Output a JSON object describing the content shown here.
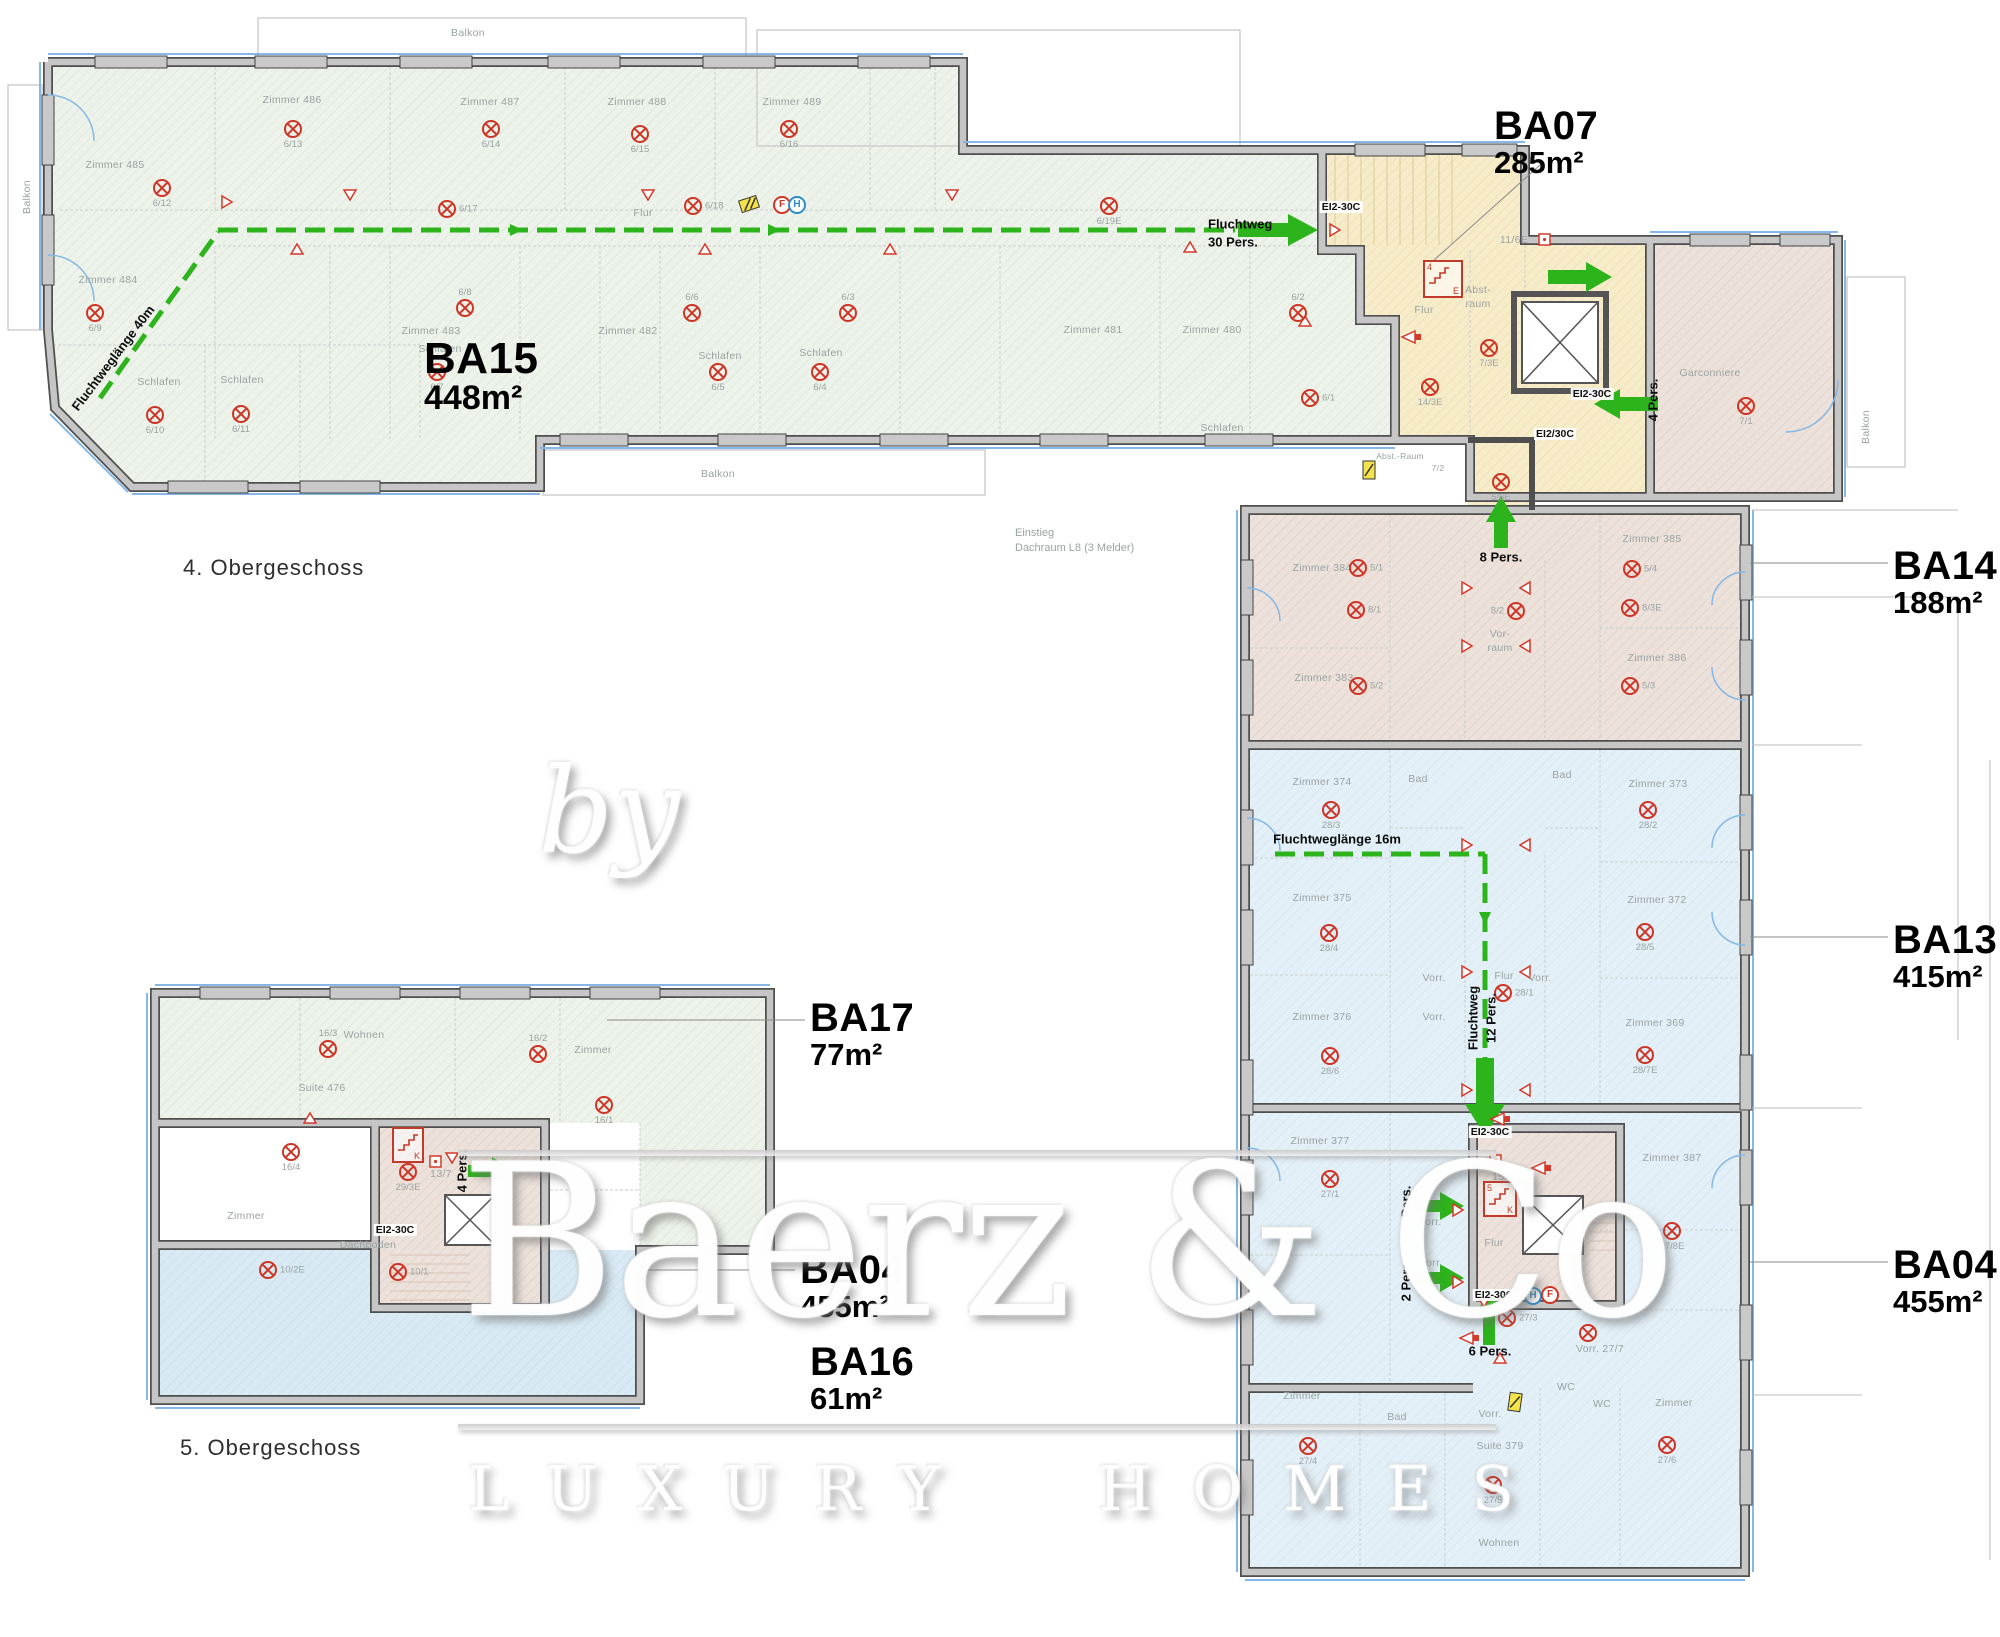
{
  "captions": [
    {
      "t": "4. Obergeschoss",
      "x": 183,
      "y": 568
    },
    {
      "t": "5. Obergeschoss",
      "x": 180,
      "y": 1448
    }
  ],
  "notes": [
    {
      "t": "Einstieg",
      "x": 1015,
      "y": 533
    },
    {
      "t": "Dachraum L8 (3 Melder)",
      "x": 1015,
      "y": 548
    }
  ],
  "units": [
    {
      "name": "BA15",
      "area": "448m²",
      "x": 424,
      "y": 336,
      "cls": "big"
    },
    {
      "name": "BA07",
      "area": "285m²",
      "x": 1494,
      "y": 106
    },
    {
      "name": "BA14",
      "area": "188m²",
      "x": 1893,
      "y": 546
    },
    {
      "name": "BA13",
      "area": "415m²",
      "x": 1893,
      "y": 920
    },
    {
      "name": "BA04",
      "area": "455m²",
      "x": 1893,
      "y": 1245
    },
    {
      "name": "BA17",
      "area": "77m²",
      "x": 810,
      "y": 998
    },
    {
      "name": "BA04",
      "area": "455m²",
      "x": 800,
      "y": 1250
    },
    {
      "name": "BA16",
      "area": "61m²",
      "x": 810,
      "y": 1342
    }
  ],
  "rooms": [
    {
      "t": "Balkon",
      "x": 468,
      "y": 33
    },
    {
      "t": "Balkon",
      "x": 27,
      "y": 197,
      "rot": -90
    },
    {
      "t": "Balkon",
      "x": 718,
      "y": 474
    },
    {
      "t": "Balkon",
      "x": 1866,
      "y": 427,
      "rot": -90
    },
    {
      "t": "Zimmer 485",
      "x": 115,
      "y": 165
    },
    {
      "t": "Zimmer 486",
      "x": 292,
      "y": 100
    },
    {
      "t": "Zimmer 487",
      "x": 490,
      "y": 102
    },
    {
      "t": "Zimmer 488",
      "x": 637,
      "y": 102
    },
    {
      "t": "Zimmer 489",
      "x": 792,
      "y": 102
    },
    {
      "t": "Zimmer 484",
      "x": 108,
      "y": 280
    },
    {
      "t": "Zimmer 483",
      "x": 431,
      "y": 331
    },
    {
      "t": "Zimmer 482",
      "x": 628,
      "y": 331
    },
    {
      "t": "Zimmer 481",
      "x": 1093,
      "y": 330
    },
    {
      "t": "Zimmer 480",
      "x": 1212,
      "y": 330
    },
    {
      "t": "Flur",
      "x": 643,
      "y": 213
    },
    {
      "t": "Schlafen",
      "x": 159,
      "y": 382
    },
    {
      "t": "Schlafen",
      "x": 242,
      "y": 380
    },
    {
      "t": "Schlafen",
      "x": 440,
      "y": 349
    },
    {
      "t": "Schlafen",
      "x": 720,
      "y": 356
    },
    {
      "t": "Schlafen",
      "x": 821,
      "y": 353
    },
    {
      "t": "Schlafen",
      "x": 1222,
      "y": 428
    },
    {
      "t": "Garconniere",
      "x": 1710,
      "y": 373
    },
    {
      "t": "Flur",
      "x": 1424,
      "y": 310
    },
    {
      "t": "Abst-",
      "x": 1478,
      "y": 290
    },
    {
      "t": "raum",
      "x": 1478,
      "y": 304
    },
    {
      "t": "Abst.-Raum",
      "x": 1400,
      "y": 456,
      "cls": "xs"
    },
    {
      "t": "7/2",
      "x": 1438,
      "y": 468,
      "cls": "xs"
    },
    {
      "t": "11/6E",
      "x": 1514,
      "y": 240
    },
    {
      "t": "15/6",
      "x": 1503,
      "y": 1177
    },
    {
      "t": "13/7",
      "x": 441,
      "y": 1174
    },
    {
      "t": "Zimmer 384",
      "x": 1322,
      "y": 568
    },
    {
      "t": "Zimmer 385",
      "x": 1652,
      "y": 539
    },
    {
      "t": "Zimmer 383",
      "x": 1324,
      "y": 678
    },
    {
      "t": "Zimmer 386",
      "x": 1657,
      "y": 658
    },
    {
      "t": "Vor-",
      "x": 1500,
      "y": 634
    },
    {
      "t": "raum",
      "x": 1500,
      "y": 648
    },
    {
      "t": "Zimmer 374",
      "x": 1322,
      "y": 782
    },
    {
      "t": "Bad",
      "x": 1418,
      "y": 779
    },
    {
      "t": "Bad",
      "x": 1562,
      "y": 775
    },
    {
      "t": "Zimmer 373",
      "x": 1658,
      "y": 784
    },
    {
      "t": "Zimmer 375",
      "x": 1322,
      "y": 898
    },
    {
      "t": "Zimmer 372",
      "x": 1657,
      "y": 900
    },
    {
      "t": "Vorr.",
      "x": 1434,
      "y": 978
    },
    {
      "t": "Flur",
      "x": 1504,
      "y": 976
    },
    {
      "t": "Vorr.",
      "x": 1540,
      "y": 978
    },
    {
      "t": "Vorr.",
      "x": 1434,
      "y": 1017
    },
    {
      "t": "Zimmer 376",
      "x": 1322,
      "y": 1017
    },
    {
      "t": "Zimmer 369",
      "x": 1655,
      "y": 1023
    },
    {
      "t": "Zimmer 377",
      "x": 1320,
      "y": 1141
    },
    {
      "t": "Zimmer 387",
      "x": 1672,
      "y": 1158
    },
    {
      "t": "Vorr.",
      "x": 1430,
      "y": 1222
    },
    {
      "t": "Vorr.",
      "x": 1431,
      "y": 1263
    },
    {
      "t": "Flur",
      "x": 1494,
      "y": 1243
    },
    {
      "t": "Zimmer",
      "x": 1302,
      "y": 1396
    },
    {
      "t": "Bad",
      "x": 1397,
      "y": 1417
    },
    {
      "t": "Vorr.",
      "x": 1490,
      "y": 1414
    },
    {
      "t": "Suite 379",
      "x": 1500,
      "y": 1446
    },
    {
      "t": "WC",
      "x": 1566,
      "y": 1387
    },
    {
      "t": "WC",
      "x": 1602,
      "y": 1404
    },
    {
      "t": "Zimmer",
      "x": 1674,
      "y": 1403
    },
    {
      "t": "Wohnen",
      "x": 1499,
      "y": 1543
    },
    {
      "t": "Vorr. 27/7",
      "x": 1600,
      "y": 1349
    },
    {
      "t": "Wohnen",
      "x": 364,
      "y": 1035
    },
    {
      "t": "Suite 476",
      "x": 322,
      "y": 1088
    },
    {
      "t": "Zimmer",
      "x": 593,
      "y": 1050
    },
    {
      "t": "Zimmer",
      "x": 246,
      "y": 1216
    },
    {
      "t": "Dachboden",
      "x": 368,
      "y": 1245
    }
  ],
  "detectors": [
    {
      "t": "6/12",
      "x": 162,
      "y": 188,
      "lp": "b"
    },
    {
      "t": "6/9",
      "x": 95,
      "y": 313,
      "lp": "b"
    },
    {
      "t": "6/13",
      "x": 293,
      "y": 129,
      "lp": "b"
    },
    {
      "t": "6/14",
      "x": 491,
      "y": 129,
      "lp": "b"
    },
    {
      "t": "6/15",
      "x": 640,
      "y": 134,
      "lp": "b"
    },
    {
      "t": "6/16",
      "x": 789,
      "y": 129,
      "lp": "b"
    },
    {
      "t": "6/17",
      "x": 447,
      "y": 209,
      "lp": "r"
    },
    {
      "t": "6/18",
      "x": 693,
      "y": 206,
      "lp": "r"
    },
    {
      "t": "6/19E",
      "x": 1109,
      "y": 206,
      "lp": "b"
    },
    {
      "t": "6/10",
      "x": 155,
      "y": 415,
      "lp": "b"
    },
    {
      "t": "6/11",
      "x": 241,
      "y": 414,
      "lp": "b"
    },
    {
      "t": "6/7",
      "x": 437,
      "y": 372,
      "lp": "b"
    },
    {
      "t": "6/5",
      "x": 718,
      "y": 372,
      "lp": "b"
    },
    {
      "t": "6/4",
      "x": 820,
      "y": 372,
      "lp": "b"
    },
    {
      "t": "6/8",
      "x": 465,
      "y": 308,
      "lp": "a"
    },
    {
      "t": "6/6",
      "x": 692,
      "y": 313,
      "lp": "a"
    },
    {
      "t": "6/3",
      "x": 848,
      "y": 313,
      "lp": "a"
    },
    {
      "t": "6/2",
      "x": 1298,
      "y": 313,
      "lp": "a"
    },
    {
      "t": "6/1",
      "x": 1310,
      "y": 398,
      "lp": "r"
    },
    {
      "t": "7/3E",
      "x": 1489,
      "y": 348,
      "lp": "b"
    },
    {
      "t": "14/3E",
      "x": 1430,
      "y": 387,
      "lp": "b"
    },
    {
      "t": "7/1",
      "x": 1746,
      "y": 406,
      "lp": "b"
    },
    {
      "t": "5/6E",
      "x": 1501,
      "y": 482,
      "lp": "b"
    },
    {
      "t": "5/1",
      "x": 1358,
      "y": 568,
      "lp": "r"
    },
    {
      "t": "5/4",
      "x": 1632,
      "y": 569,
      "lp": "r"
    },
    {
      "t": "8/1",
      "x": 1356,
      "y": 610,
      "lp": "r"
    },
    {
      "t": "8/2",
      "x": 1516,
      "y": 611,
      "lp": "l"
    },
    {
      "t": "8/3E",
      "x": 1630,
      "y": 608,
      "lp": "r"
    },
    {
      "t": "5/2",
      "x": 1358,
      "y": 686,
      "lp": "r"
    },
    {
      "t": "5/3",
      "x": 1630,
      "y": 686,
      "lp": "r"
    },
    {
      "t": "28/3",
      "x": 1331,
      "y": 810,
      "lp": "b"
    },
    {
      "t": "28/2",
      "x": 1648,
      "y": 810,
      "lp": "b"
    },
    {
      "t": "28/4",
      "x": 1329,
      "y": 933,
      "lp": "b"
    },
    {
      "t": "28/5",
      "x": 1645,
      "y": 932,
      "lp": "b"
    },
    {
      "t": "28/1",
      "x": 1503,
      "y": 993,
      "lp": "r"
    },
    {
      "t": "28/6",
      "x": 1330,
      "y": 1056,
      "lp": "b"
    },
    {
      "t": "28/7E",
      "x": 1645,
      "y": 1055,
      "lp": "b"
    },
    {
      "t": "27/1",
      "x": 1330,
      "y": 1179,
      "lp": "b"
    },
    {
      "t": "27/3",
      "x": 1507,
      "y": 1318,
      "lp": "r"
    },
    {
      "t": "27/8E",
      "x": 1672,
      "y": 1231,
      "lp": "b"
    },
    {
      "t": "",
      "x": 1588,
      "y": 1333,
      "lp": "b"
    },
    {
      "t": "27/4",
      "x": 1308,
      "y": 1446,
      "lp": "b"
    },
    {
      "t": "27/6",
      "x": 1667,
      "y": 1445,
      "lp": "b"
    },
    {
      "t": "27/5",
      "x": 1493,
      "y": 1485,
      "lp": "b"
    },
    {
      "t": "16/3",
      "x": 328,
      "y": 1049,
      "lp": "a"
    },
    {
      "t": "16/2",
      "x": 538,
      "y": 1054,
      "lp": "a"
    },
    {
      "t": "16/1",
      "x": 604,
      "y": 1105,
      "lp": "b"
    },
    {
      "t": "16/4",
      "x": 291,
      "y": 1152,
      "lp": "b"
    },
    {
      "t": "29/3E",
      "x": 408,
      "y": 1172,
      "lp": "b"
    },
    {
      "t": "10/2E",
      "x": 268,
      "y": 1270,
      "lp": "r"
    },
    {
      "t": "10/1",
      "x": 398,
      "y": 1272,
      "lp": "r"
    }
  ],
  "escape_texts": [
    {
      "t": "Fluchtweg",
      "x": 1208,
      "y": 224,
      "cls": "left"
    },
    {
      "t": "30 Pers.",
      "x": 1208,
      "y": 242,
      "cls": "left"
    },
    {
      "t": "Fluchtweglänge 40m",
      "x": 113,
      "y": 358,
      "rot": -53
    },
    {
      "t": "8 Pers.",
      "x": 1501,
      "y": 557
    },
    {
      "t": "Fluchtweglänge 16m",
      "x": 1337,
      "y": 839
    },
    {
      "t": "Fluchtweg",
      "x": 1473,
      "y": 1018,
      "rot": -90
    },
    {
      "t": "12 Pers.",
      "x": 1491,
      "y": 1018,
      "rot": -90
    },
    {
      "t": "2 Pers.",
      "x": 1406,
      "y": 1207,
      "rot": -90
    },
    {
      "t": "2 Pers.",
      "x": 1406,
      "y": 1280,
      "rot": -90
    },
    {
      "t": "6 Pers.",
      "x": 1490,
      "y": 1351
    },
    {
      "t": "4 Pers.",
      "x": 1653,
      "y": 400,
      "rot": -90
    },
    {
      "t": "4 Pers.",
      "x": 462,
      "y": 1171,
      "rot": -90
    }
  ],
  "ei_tags": [
    {
      "t": "EI2-30C",
      "x": 1341,
      "y": 207
    },
    {
      "t": "EI2-30C",
      "x": 1592,
      "y": 394
    },
    {
      "t": "EI2/30C",
      "x": 1555,
      "y": 434
    },
    {
      "t": "EI2-30C",
      "x": 1490,
      "y": 1132
    },
    {
      "t": "EI2-30C",
      "x": 1494,
      "y": 1295
    },
    {
      "t": "EI2-30C",
      "x": 395,
      "y": 1230
    }
  ],
  "fh": [
    {
      "t": "F",
      "x": 781,
      "y": 204,
      "c": "red"
    },
    {
      "t": "H",
      "x": 796,
      "y": 204,
      "c": "blue"
    },
    {
      "t": "H",
      "x": 1532,
      "y": 1295,
      "c": "blue"
    },
    {
      "t": "F",
      "x": 1549,
      "y": 1294,
      "c": "red"
    }
  ],
  "stairs": [
    {
      "a": "4",
      "b": "E",
      "x": 1443,
      "y": 279,
      "w": 36,
      "h": 34
    },
    {
      "a": "5",
      "b": "K",
      "x": 1500,
      "y": 1199,
      "w": 30,
      "h": 32
    },
    {
      "a": "",
      "b": "K",
      "x": 408,
      "y": 1145,
      "w": 28,
      "h": 32
    }
  ],
  "watermark": {
    "by": "by",
    "main": "Baerz & Co",
    "sub": "LUXURY HOMES"
  }
}
